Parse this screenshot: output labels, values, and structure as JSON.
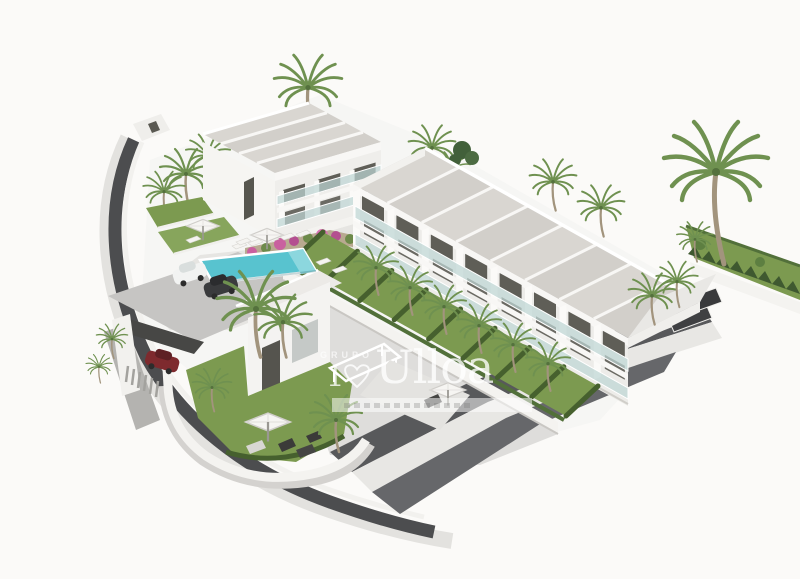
{
  "image": {
    "kind": "3D architectural rendering",
    "subject": "Aerial view of a modern white residential development: an eight-unit terraced townhouse row, a two-storey apartment block, communal swimming pool with sun loungers, parking with cars, landscaped gardens with palm trees, bougainvillea wall and a curved perimeter road on a plain white background",
    "background": "#fbfaf8"
  },
  "watermark": {
    "top_text": "GRUPO",
    "brand_text": "Ulloa",
    "monogram_numeral": "1",
    "heart_icon": "outline-heart",
    "tagline_bar": "translucent strip with illegible small text",
    "text_color": "rgba(255,255,255,0.78)"
  },
  "palette": {
    "background": "#fbfaf8",
    "facade_white": "#f3f2ef",
    "roof_gray": "#d7d4cf",
    "glass_railing": "#cfe0de",
    "window_dark": "#5d5c55",
    "grass_green": "#7c9a50",
    "hedge_green": "#46602e",
    "palm_green": "#6f9150",
    "pool_turquoise": "#58c3cf",
    "road_dark": "#4b4c4e",
    "pavement_light": "#d9d8d5",
    "bougainvillea_pink": "#c9609f",
    "stone_tan": "#b3a287",
    "car_red": "#7e2a2e"
  },
  "scene": {
    "townhouse_row_units": 8,
    "apartment_block_units": 3,
    "pools": 1,
    "visible_cars": 3,
    "parasols": 4,
    "features": [
      "swimming pool",
      "sun loungers",
      "parasols",
      "palm trees",
      "hedged private gardens",
      "bougainvillea retaining wall",
      "carport with red car",
      "curved perimeter road",
      "stepped dark retaining terraces",
      "white perimeter walls"
    ]
  }
}
